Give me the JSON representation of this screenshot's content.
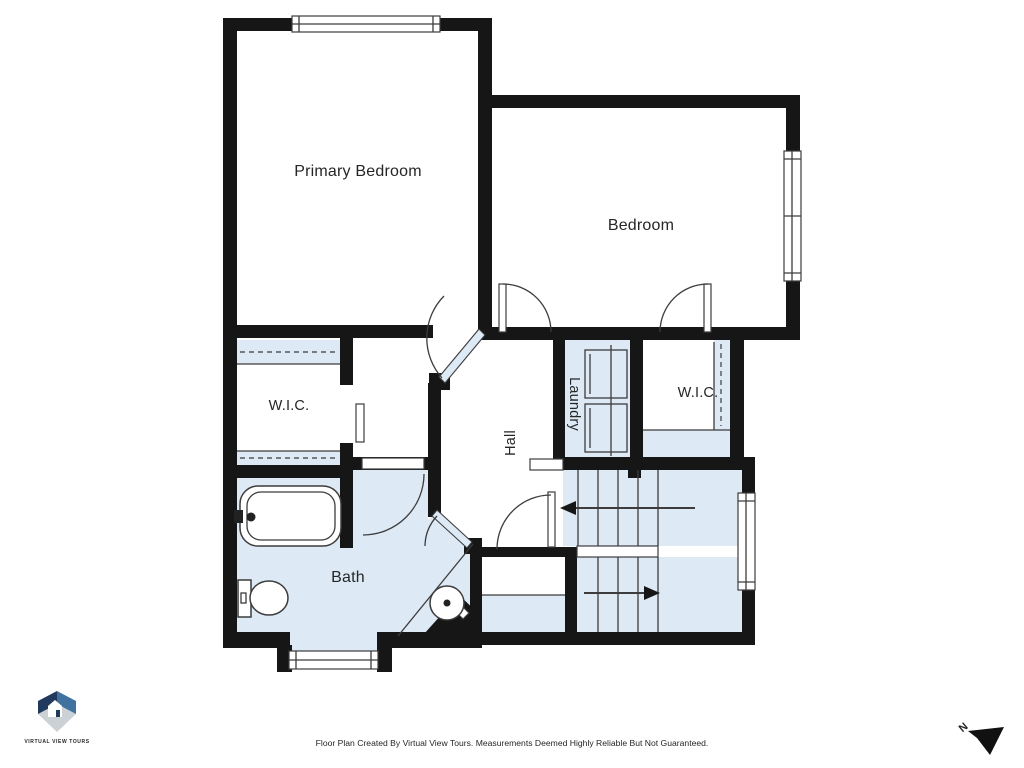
{
  "plan": {
    "rooms": [
      {
        "id": "primary-bedroom",
        "label": "Primary Bedroom"
      },
      {
        "id": "bedroom",
        "label": "Bedroom"
      },
      {
        "id": "wic-left",
        "label": "W.I.C."
      },
      {
        "id": "laundry",
        "label": "Laundry"
      },
      {
        "id": "wic-right",
        "label": "W.I.C."
      },
      {
        "id": "hall",
        "label": "Hall"
      },
      {
        "id": "bath",
        "label": "Bath"
      }
    ]
  },
  "branding": {
    "logo_text": "VIRTUAL VIEW TOURS"
  },
  "footer": {
    "disclaimer": "Floor Plan Created By Virtual View Tours. Measurements Deemed Highly Reliable But Not Guaranteed."
  },
  "compass": {
    "label": "N"
  },
  "colors": {
    "wall": "#161616",
    "floor_fill": "#dde9f5",
    "line": "#3c3c3c",
    "text": "#262626",
    "logo_navy": "#20395c",
    "logo_blue": "#41719f",
    "logo_gray": "#ccd1d6"
  }
}
